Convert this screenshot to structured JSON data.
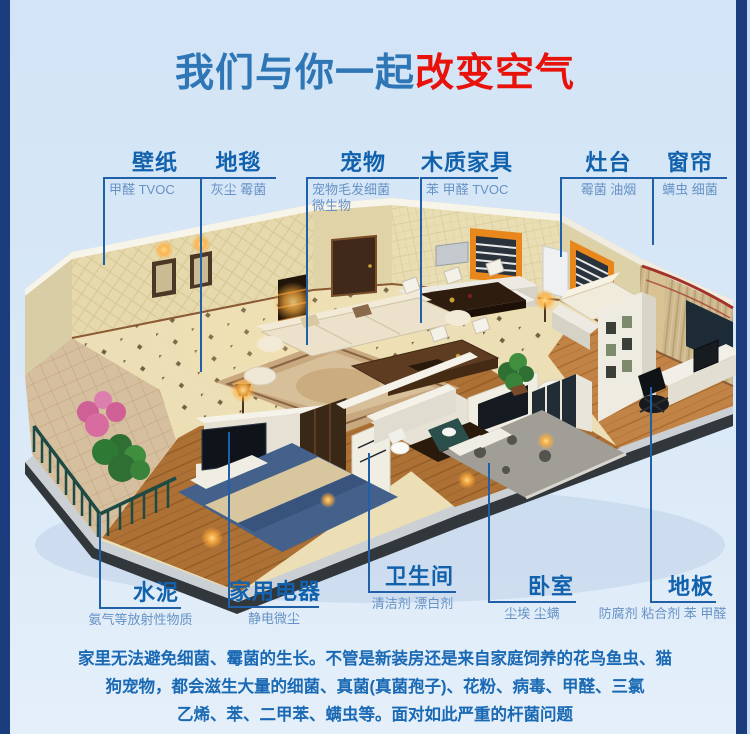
{
  "header": {
    "title_blue": "我们与你一起",
    "title_red": "改变空气"
  },
  "colors": {
    "accent_blue": "#2e76b5",
    "accent_red": "#e8120b",
    "callout_title": "#1161ad",
    "callout_sub": "#6792c5",
    "leader_line": "#2060a8",
    "border_navy": "#1c3d7d",
    "background_top": "#d2e4f6",
    "background_bottom": "#e4eff9",
    "paragraph_text": "#1a69b4"
  },
  "callouts": {
    "top": [
      {
        "id": "wallpaper",
        "title": "壁纸",
        "sub": "甲醛 TVOC"
      },
      {
        "id": "carpet",
        "title": "地毯",
        "sub": "灰尘 霉菌"
      },
      {
        "id": "pets",
        "title": "宠物",
        "sub": "宠物毛发细菌",
        "sub2": "微生物"
      },
      {
        "id": "wood-furniture",
        "title": "木质家具",
        "sub": "苯 甲醛 TVOC"
      },
      {
        "id": "stove",
        "title": "灶台",
        "sub": "霉菌 油烟"
      },
      {
        "id": "curtain",
        "title": "窗帘",
        "sub": "螨虫 细菌"
      }
    ],
    "bottom": [
      {
        "id": "cement",
        "title": "水泥",
        "sub": "氨气等放射性物质"
      },
      {
        "id": "appliances",
        "title": "家用电器",
        "sub": "静电微尘"
      },
      {
        "id": "bathroom",
        "title": "卫生间",
        "sub": "清洁剂 漂白剂"
      },
      {
        "id": "bedroom",
        "title": "卧室",
        "sub": "尘埃 尘螨"
      },
      {
        "id": "floor",
        "title": "地板",
        "sub": "防腐剂 粘合剂 苯 甲醛"
      }
    ]
  },
  "paragraph": {
    "line1": "家里无法避免细菌、霉菌的生长。不管是新装房还是来自家庭饲养的花鸟鱼虫、猫",
    "line2": "狗宠物，都会滋生大量的细菌、真菌(真菌孢子)、花粉、病毒、甲醛、三氯",
    "line3": "乙烯、苯、二甲苯、螨虫等。面对如此严重的杆菌问题"
  },
  "illustration": {
    "description": "isometric-cutaway-apartment-3d-render"
  }
}
